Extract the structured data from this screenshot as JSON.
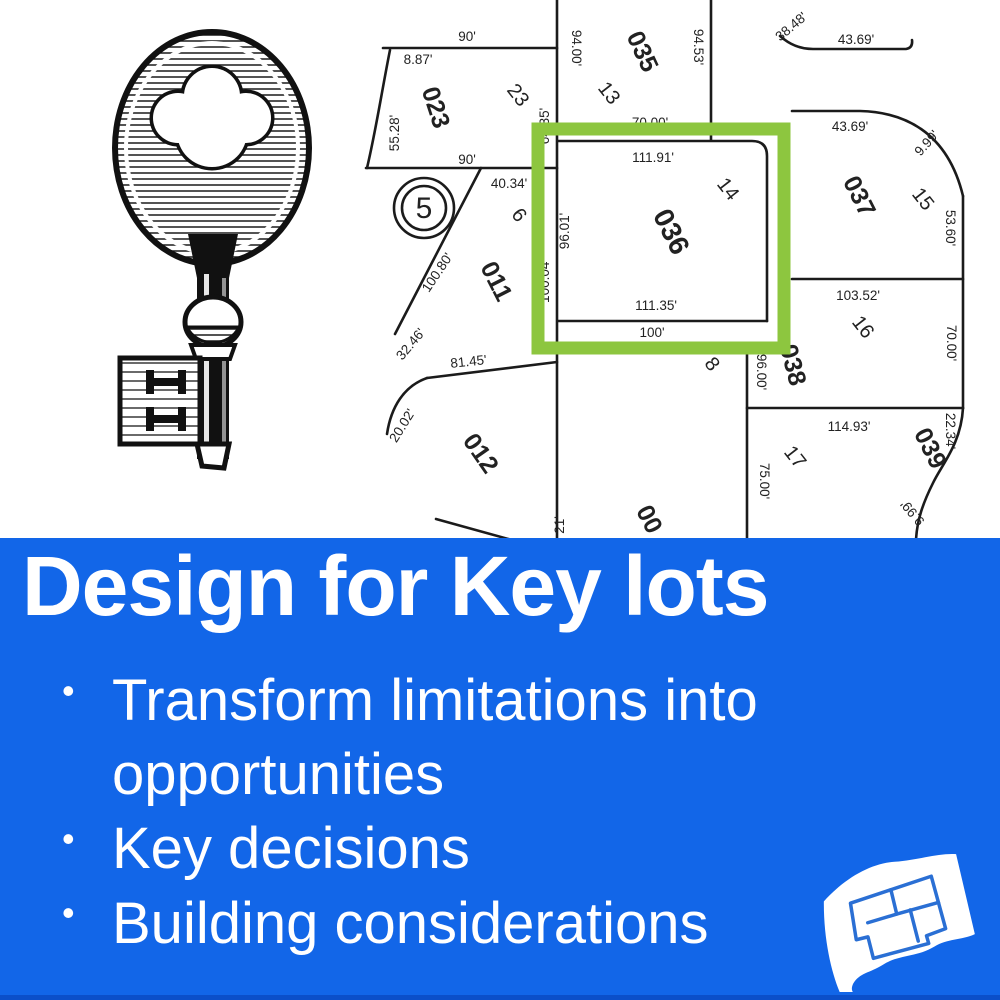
{
  "banner": {
    "title": "Design for Key lots",
    "bullets": [
      "Transform limitations into opportunities",
      "Key decisions",
      "Building considerations"
    ],
    "background_color": "#1266e8",
    "text_color": "#ffffff"
  },
  "map": {
    "highlight_color": "#8dc63f",
    "line_color": "#1b1b1b",
    "text_color": "#222222",
    "highlighted_lot": "036",
    "labels": [
      {
        "text": "90'",
        "x": 467,
        "y": 41
      },
      {
        "text": "8.87'",
        "x": 418,
        "y": 64
      },
      {
        "text": "023",
        "x": 428,
        "y": 110,
        "rot": 72,
        "size": 25,
        "bold": true
      },
      {
        "text": "23",
        "x": 513,
        "y": 99,
        "rot": 52,
        "size": 20
      },
      {
        "text": "55.28'",
        "x": 399,
        "y": 133,
        "rot": -90
      },
      {
        "text": "94.00'",
        "x": 572,
        "y": 48,
        "rot": 90
      },
      {
        "text": "035",
        "x": 635,
        "y": 55,
        "rot": 65,
        "size": 25,
        "bold": true
      },
      {
        "text": "94.53'",
        "x": 694,
        "y": 47,
        "rot": 90
      },
      {
        "text": "13",
        "x": 604,
        "y": 97,
        "rot": 52,
        "size": 20
      },
      {
        "text": "38.48'",
        "x": 794,
        "y": 30,
        "rot": -40
      },
      {
        "text": "43.69'",
        "x": 856,
        "y": 44
      },
      {
        "text": "64.35'",
        "x": 549,
        "y": 126,
        "rot": -90
      },
      {
        "text": "70.00'",
        "x": 650,
        "y": 127
      },
      {
        "text": "43.69'",
        "x": 850,
        "y": 131
      },
      {
        "text": "9.99'",
        "x": 930,
        "y": 146,
        "rot": -48
      },
      {
        "text": "037",
        "x": 852,
        "y": 200,
        "rot": 63,
        "size": 25,
        "bold": true
      },
      {
        "text": "15",
        "x": 918,
        "y": 203,
        "rot": 52,
        "size": 20
      },
      {
        "text": "53.60'",
        "x": 946,
        "y": 228,
        "rot": 90
      },
      {
        "text": "90'",
        "x": 467,
        "y": 164
      },
      {
        "text": "111.91'",
        "x": 653,
        "y": 162
      },
      {
        "text": "14",
        "x": 723,
        "y": 193,
        "rot": 52,
        "size": 20
      },
      {
        "text": "036",
        "x": 663,
        "y": 236,
        "rot": 63,
        "size": 28,
        "bold": true
      },
      {
        "text": "96.01'",
        "x": 569,
        "y": 231,
        "rot": -90
      },
      {
        "text": "100.04'",
        "x": 549,
        "y": 281,
        "rot": -90
      },
      {
        "text": "40.34'",
        "x": 509,
        "y": 188
      },
      {
        "text": "6",
        "x": 514,
        "y": 219,
        "rot": 52,
        "size": 20
      },
      {
        "text": "5",
        "x": 424,
        "y": 218,
        "size": 30
      },
      {
        "text": "100.80'",
        "x": 441,
        "y": 275,
        "rot": -56
      },
      {
        "text": "011",
        "x": 489,
        "y": 285,
        "rot": 63,
        "size": 25,
        "bold": true
      },
      {
        "text": "111.35'",
        "x": 656,
        "y": 310
      },
      {
        "text": "100'",
        "x": 652,
        "y": 337
      },
      {
        "text": "103.52'",
        "x": 858,
        "y": 300
      },
      {
        "text": "16",
        "x": 858,
        "y": 331,
        "rot": 52,
        "size": 20
      },
      {
        "text": "70.00'",
        "x": 947,
        "y": 343,
        "rot": 90
      },
      {
        "text": "32.46'",
        "x": 414,
        "y": 347,
        "rot": -50
      },
      {
        "text": "81.45'",
        "x": 469,
        "y": 366,
        "rot": -6
      },
      {
        "text": "8",
        "x": 707,
        "y": 368,
        "rot": 52,
        "size": 20
      },
      {
        "text": "038",
        "x": 785,
        "y": 367,
        "rot": 75,
        "size": 25,
        "bold": true
      },
      {
        "text": "96.00'",
        "x": 757,
        "y": 372,
        "rot": 90
      },
      {
        "text": "20.02'",
        "x": 406,
        "y": 428,
        "rot": -58
      },
      {
        "text": "012",
        "x": 474,
        "y": 458,
        "rot": 55,
        "size": 25,
        "bold": true
      },
      {
        "text": "114.93'",
        "x": 849,
        "y": 431
      },
      {
        "text": "22.34'",
        "x": 946,
        "y": 431,
        "rot": 90
      },
      {
        "text": "17",
        "x": 790,
        "y": 461,
        "rot": 52,
        "size": 20
      },
      {
        "text": "75.00'",
        "x": 760,
        "y": 481,
        "rot": 90
      },
      {
        "text": "039",
        "x": 923,
        "y": 452,
        "rot": 63,
        "size": 25,
        "bold": true
      },
      {
        "text": "9.99'",
        "x": 916,
        "y": 510,
        "rot": -130
      },
      {
        "text": "21'",
        "x": 564,
        "y": 525,
        "rot": -90
      },
      {
        "text": "00",
        "x": 642,
        "y": 523,
        "rot": 63,
        "size": 25,
        "bold": true
      }
    ]
  },
  "icons": {
    "key_illustration": "vintage-skeleton-key",
    "blueprint_icon": "curled-blueprint-plan"
  }
}
